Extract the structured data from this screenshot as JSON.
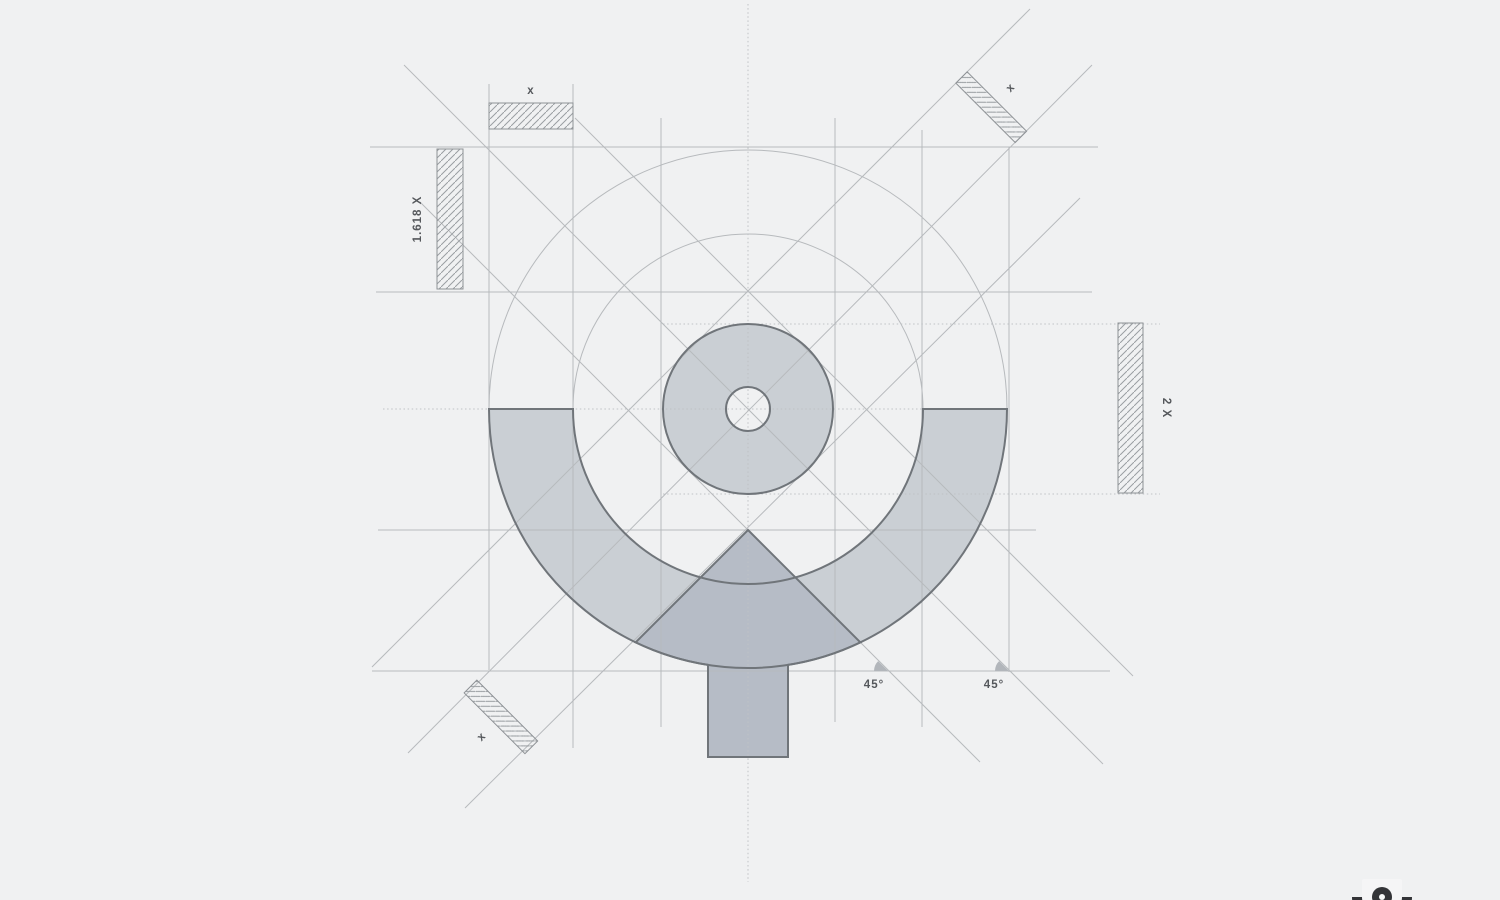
{
  "page": {
    "description": "Logo construction grid blueprint",
    "background": "#f0f1f2"
  },
  "labels": {
    "top_width": "x",
    "left_height": "1.618 X",
    "right_height": "2 X",
    "diag_top_right": "x",
    "diag_bottom_left": "x",
    "angle_left": "45°",
    "angle_right": "45°"
  },
  "colors": {
    "background": "#f0f1f2",
    "guide_line": "#b7babd",
    "arc_fill": "#cacfd4",
    "triangle_fill": "#b6bcc6",
    "logo_stroke": "#70757a",
    "hatch_line": "#9a9ea2",
    "hatch_border": "#8e9296",
    "label_text": "#55585c",
    "mini_logo": "#333437"
  }
}
